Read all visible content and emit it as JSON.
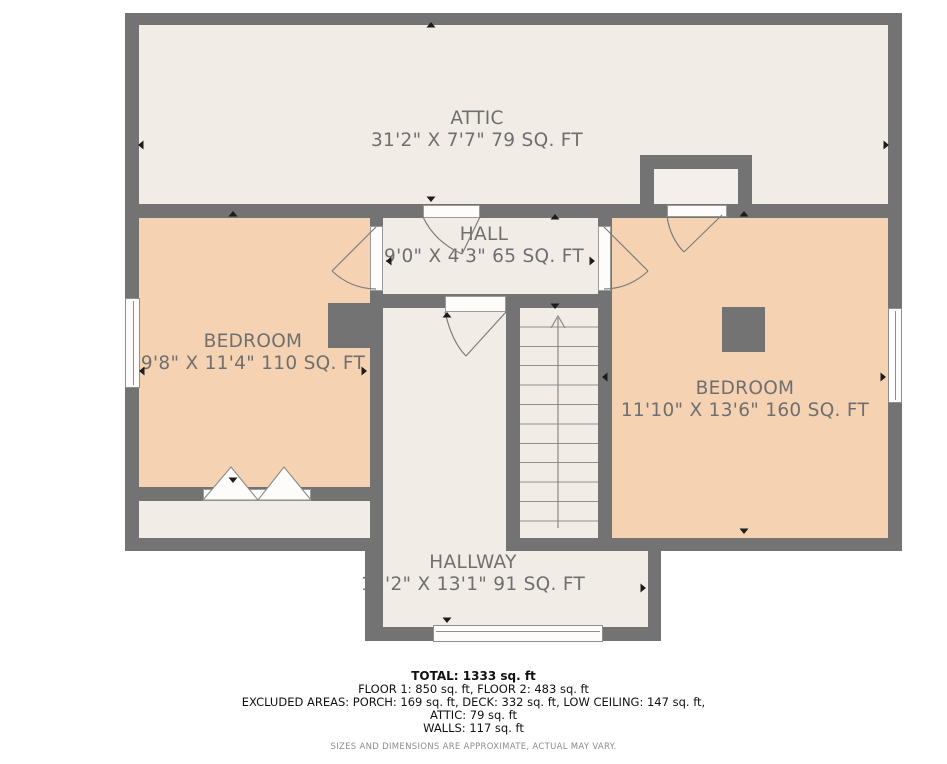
{
  "colors": {
    "wall": "#737373",
    "floor_light": "#f2ece7",
    "floor_peach": "#f5d3b2",
    "label_text": "#6f6f6f",
    "marker_black": "#1c1c1c",
    "summary_text": "#111111",
    "disclaimer_text": "#8d8d8d"
  },
  "rooms": [
    {
      "id": "attic",
      "name": "ATTIC",
      "dims": "31'2\" X 7'7\" 79 SQ. FT"
    },
    {
      "id": "hall",
      "name": "HALL",
      "dims": "9'0\" X 4'3\" 65 SQ. FT"
    },
    {
      "id": "bedroom-left",
      "name": "BEDROOM",
      "dims": "9'8\" X 11'4\" 110 SQ. FT"
    },
    {
      "id": "bedroom-right",
      "name": "BEDROOM",
      "dims": "11'10\" X 13'6\" 160 SQ. FT"
    },
    {
      "id": "hallway",
      "name": "HALLWAY",
      "dims": "11'2\" X 13'1\" 91 SQ. FT"
    }
  ],
  "summary": {
    "total": "TOTAL: 1333 sq. ft",
    "floors": "FLOOR 1: 850 sq. ft, FLOOR 2: 483 sq. ft",
    "excluded": "EXCLUDED AREAS: PORCH: 169 sq. ft, DECK: 332 sq. ft, LOW CEILING: 147 sq. ft,",
    "attic": "ATTIC: 79 sq. ft",
    "walls": "WALLS: 117 sq. ft",
    "disclaimer": "SIZES AND DIMENSIONS ARE APPROXIMATE, ACTUAL MAY VARY."
  }
}
